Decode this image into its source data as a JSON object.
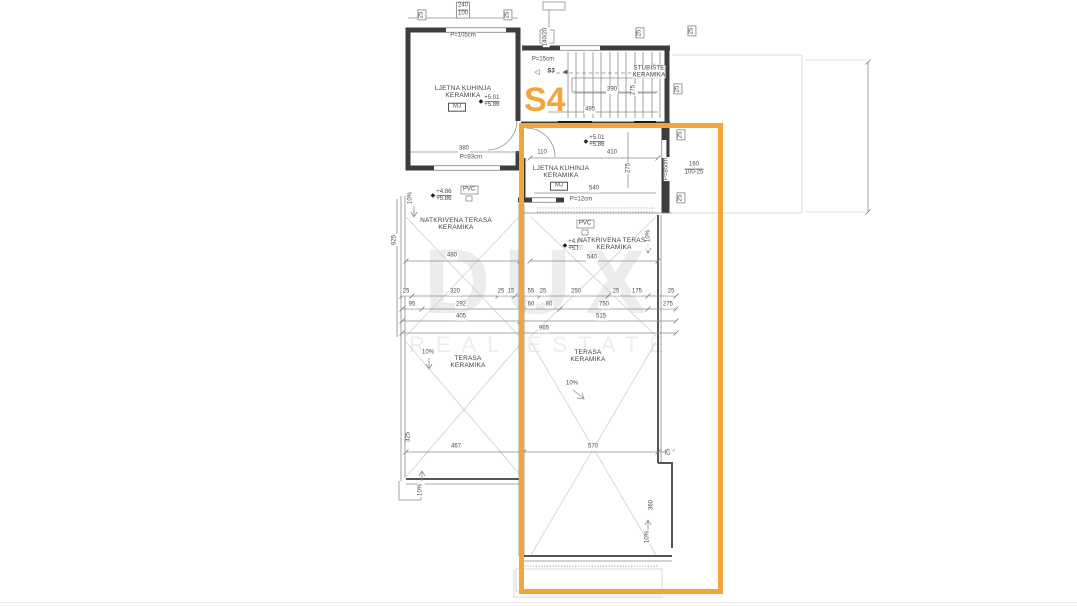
{
  "watermark": {
    "line1": "DUX",
    "line2": "REAL ESTATE"
  },
  "unit": {
    "label": "S4",
    "highlight_color": "#F0A63C"
  },
  "marks": {
    "stairs_mark": "S3"
  },
  "icons": {
    "level_marker": "◆",
    "arrow_open": "◁",
    "arrow_solid": "◀"
  },
  "rooms": {
    "kitchen_left": {
      "line1": "LJETNA KUHINJA",
      "line2": "KERAMIKA",
      "tag": "MJ"
    },
    "kitchen_right": {
      "line1": "LJETNA KUHINJA",
      "line2": "KERAMIKA",
      "tag": "MJ"
    },
    "staircase": {
      "line1": "STUBIŠTE",
      "line2": "KERAMIKA"
    },
    "covered_terrace_left": {
      "line1": "NATKRIVENA TERASA",
      "line2": "KERAMIKA"
    },
    "covered_terrace_right": {
      "line1": "NATKRIVENA TERASA",
      "line2": "KERAMIKA"
    },
    "terrace_left": {
      "line1": "TERASA",
      "line2": "KERAMIKA"
    },
    "terrace_right": {
      "line1": "TERASA",
      "line2": "KERAMIKA"
    }
  },
  "levels": {
    "kitchen_left_top": "+5.01",
    "kitchen_left_bottom": "+5.86",
    "kitchen_right_top": "+5.01",
    "kitchen_right_bottom": "+5.86",
    "covered_left_top": "+4.86",
    "covered_left_bottom": "+5.86",
    "covered_right_top": "+4.86",
    "covered_right_bottom": "+5.86"
  },
  "annotations": {
    "slope": "10%",
    "pvc": "PVC",
    "parapet_window_top": "P=105cm",
    "parapet_window_bottom": "P=93cm",
    "parapet_landing": "P=15cm",
    "parapet_right": "P=85cm",
    "parapet_strip": "P=12cm",
    "window_stack_top": "240",
    "window_stack_bottom": "100",
    "window_spec_top": "160",
    "window_spec_bottom": "100-25",
    "chimney_spec": "140/20",
    "dim_box": "25"
  },
  "dimensions": {
    "kitchen_left_width": "380",
    "stairs_width": "390",
    "stairs_run": "495",
    "stairs_depth": "275",
    "kitchen_right_seg1": "110",
    "kitchen_right_seg2": "410",
    "kitchen_right_width": "540",
    "kitchen_right_depth": "275",
    "covered_left_width": "480",
    "covered_right_width": "540",
    "left_total_height": "925",
    "chain_row1": [
      "25",
      "320",
      "25",
      "15",
      "55",
      "25",
      "250",
      "25",
      "175",
      "25"
    ],
    "chain_row2": [
      "95",
      "292",
      "60",
      "80",
      "750",
      "275"
    ],
    "chain_row3": [
      "405",
      "515"
    ],
    "chain_total": "965",
    "terrace_left_width": "467",
    "terrace_left_height": "325",
    "terrace_right_width": "570",
    "terrace_right_height": "360",
    "edge_offset": "25"
  }
}
